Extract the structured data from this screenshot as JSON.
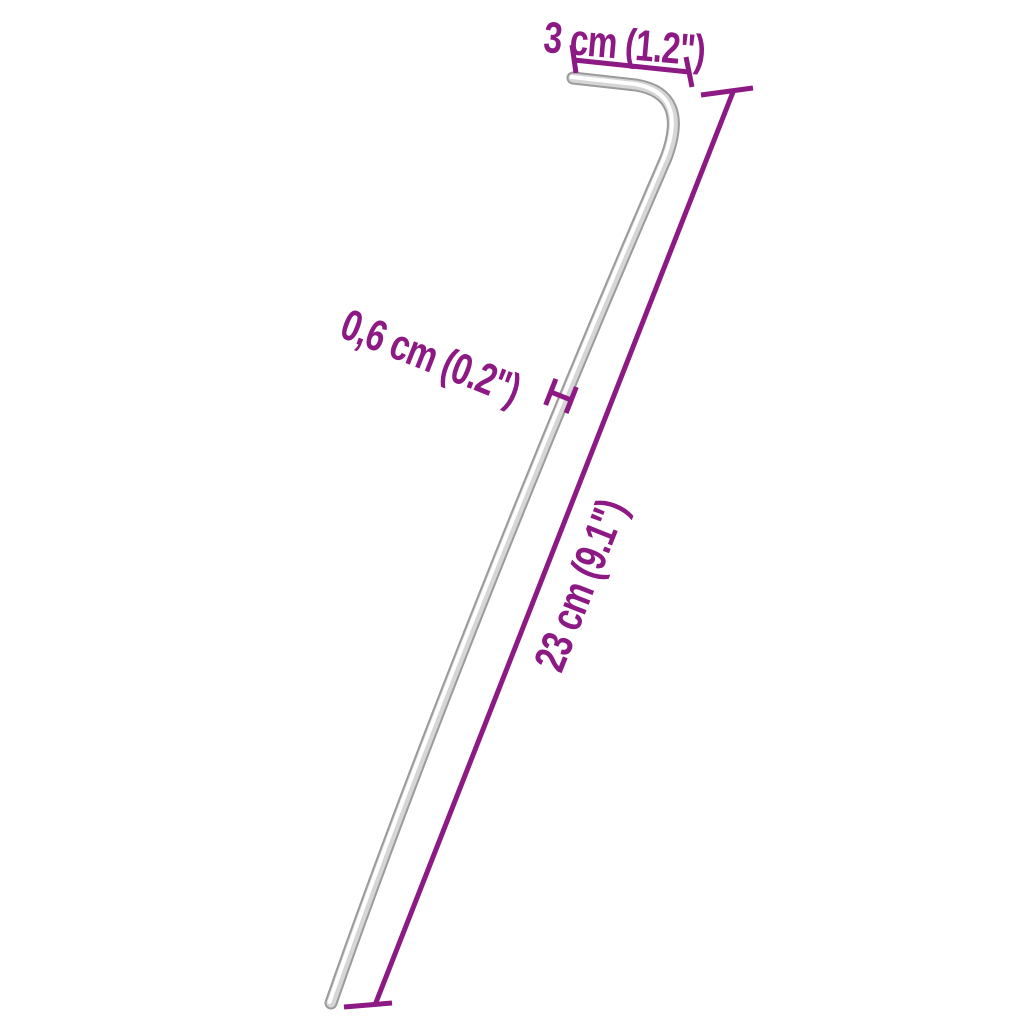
{
  "colors": {
    "background": "#ffffff",
    "dimension_accent": "#8d1a84",
    "peg_edge": "#9b9b9b",
    "peg_body": "#d6d6d6",
    "peg_highlight": "#ffffff"
  },
  "dimensions": {
    "hook_width": {
      "label": "3 cm (1.2\")"
    },
    "thickness": {
      "label": "0,6 cm (0.2\")"
    },
    "length": {
      "label": "23 cm (9.1\")"
    }
  }
}
